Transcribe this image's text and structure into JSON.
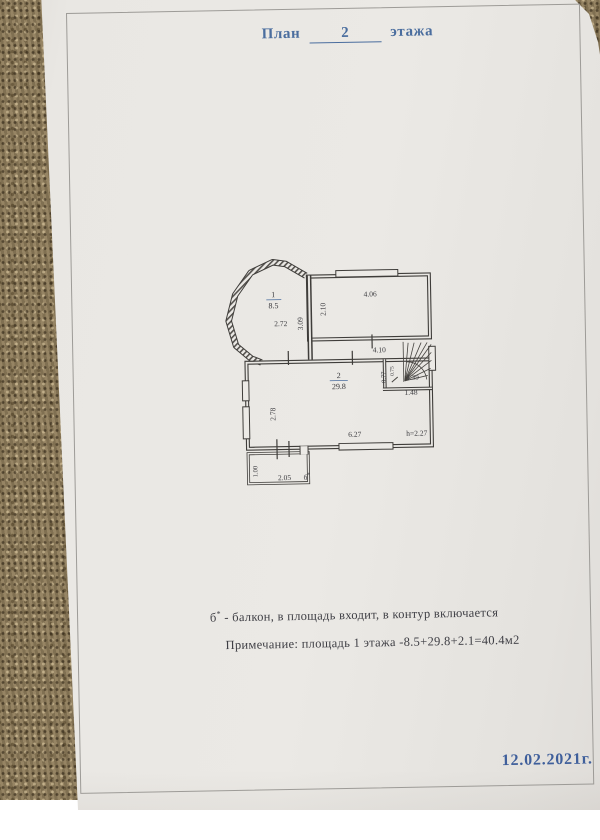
{
  "title": {
    "word": "План",
    "floor_number": "2",
    "suffix": "этажа"
  },
  "plan": {
    "room1": {
      "number": "1",
      "area": "8.5"
    },
    "room2": {
      "number": "2",
      "area": "29.8"
    },
    "dims": {
      "d272": "2.72",
      "d309": "3.09",
      "d210": "2.10",
      "d406": "4.06",
      "d410": "4.10",
      "d077": "0.77",
      "d075": "0.75",
      "d139": "1.39",
      "d148": "1.48",
      "d278": "2.78",
      "d627": "6.27",
      "height": "h=2.27",
      "d100": "1.00",
      "d205": "2.05",
      "balcony": "б",
      "balcony_sup": "*"
    }
  },
  "notes": {
    "line1_letter": "б",
    "line1_sup": "*",
    "line1_rest": " - балкон, в площадь входит, в контур включается",
    "line2": "Примечание:  площадь 1 этажа -8.5+29.8+2.1=40.4м2"
  },
  "footer": {
    "date": "12.02.2021г."
  },
  "colors": {
    "accent_blue": "#4a6d9e",
    "ink": "#3a3a3e",
    "height_red": "#9b4a40",
    "paper": "#e9e7e3",
    "fabric": "#8d7c5c"
  }
}
